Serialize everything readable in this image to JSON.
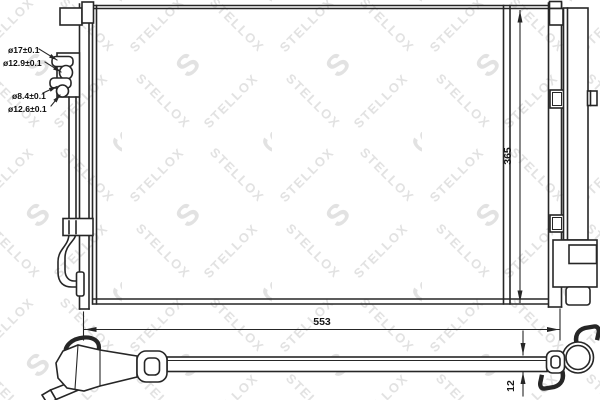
{
  "watermark": {
    "text": "STELLOX",
    "initial": "S"
  },
  "dimensions": {
    "height": "365",
    "width": "553",
    "depth": "12"
  },
  "port_labels": {
    "top_outer": "ø17±0.1",
    "top_inner": "ø12.9±0.1",
    "bottom_outer": "ø8.4±0.1",
    "bottom_inner": "ø12.6±0.1"
  },
  "colors": {
    "line": "#262626",
    "watermark": "#e2e2e2",
    "background": "#ffffff"
  }
}
